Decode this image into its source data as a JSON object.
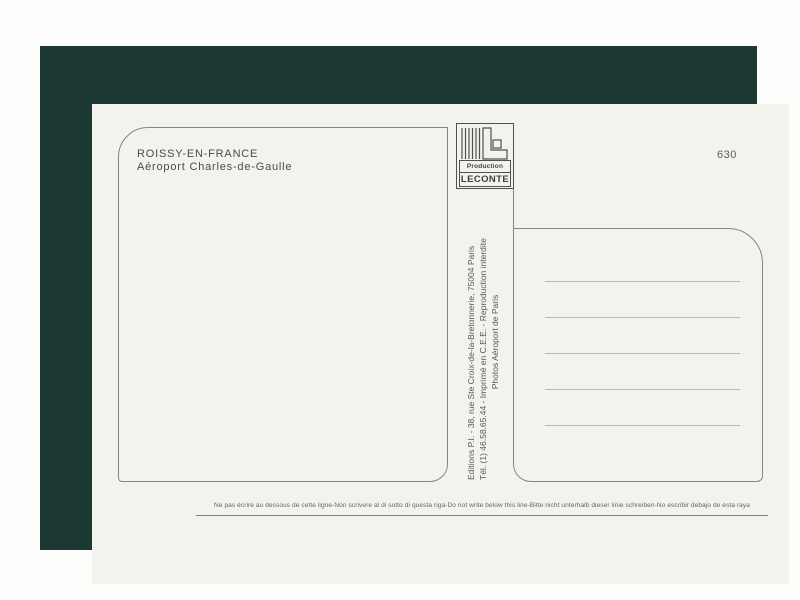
{
  "postcard": {
    "title_line1": "ROISSY-EN-FRANCE",
    "title_line2": "Aéroport Charles-de-Gaulle",
    "number": "630",
    "logo": {
      "production_label": "Production",
      "name_label": "LECONTE"
    },
    "credits": {
      "line1": "Editions P.I. - 38, rue Ste Croix-de-la-Bretonnerie, 75004 Paris",
      "line2": "Tél. (1) 46.58.65.44 - Imprimé en C.E.E. - Reproduction interdite",
      "line3": "Photos Aéroport de Paris"
    },
    "footer_note": "Ne pas écrire au dessous de cette ligne-Non scrivere al di sotto di questa riga-Do not write below this line-Bitte nicht unterhalb dieser linie schreiben-No escribir debajo de esta raya",
    "address_line_count": 5,
    "colors": {
      "frame": "#1c3832",
      "card": "#f3f3ee",
      "rule": "#84867f"
    }
  }
}
